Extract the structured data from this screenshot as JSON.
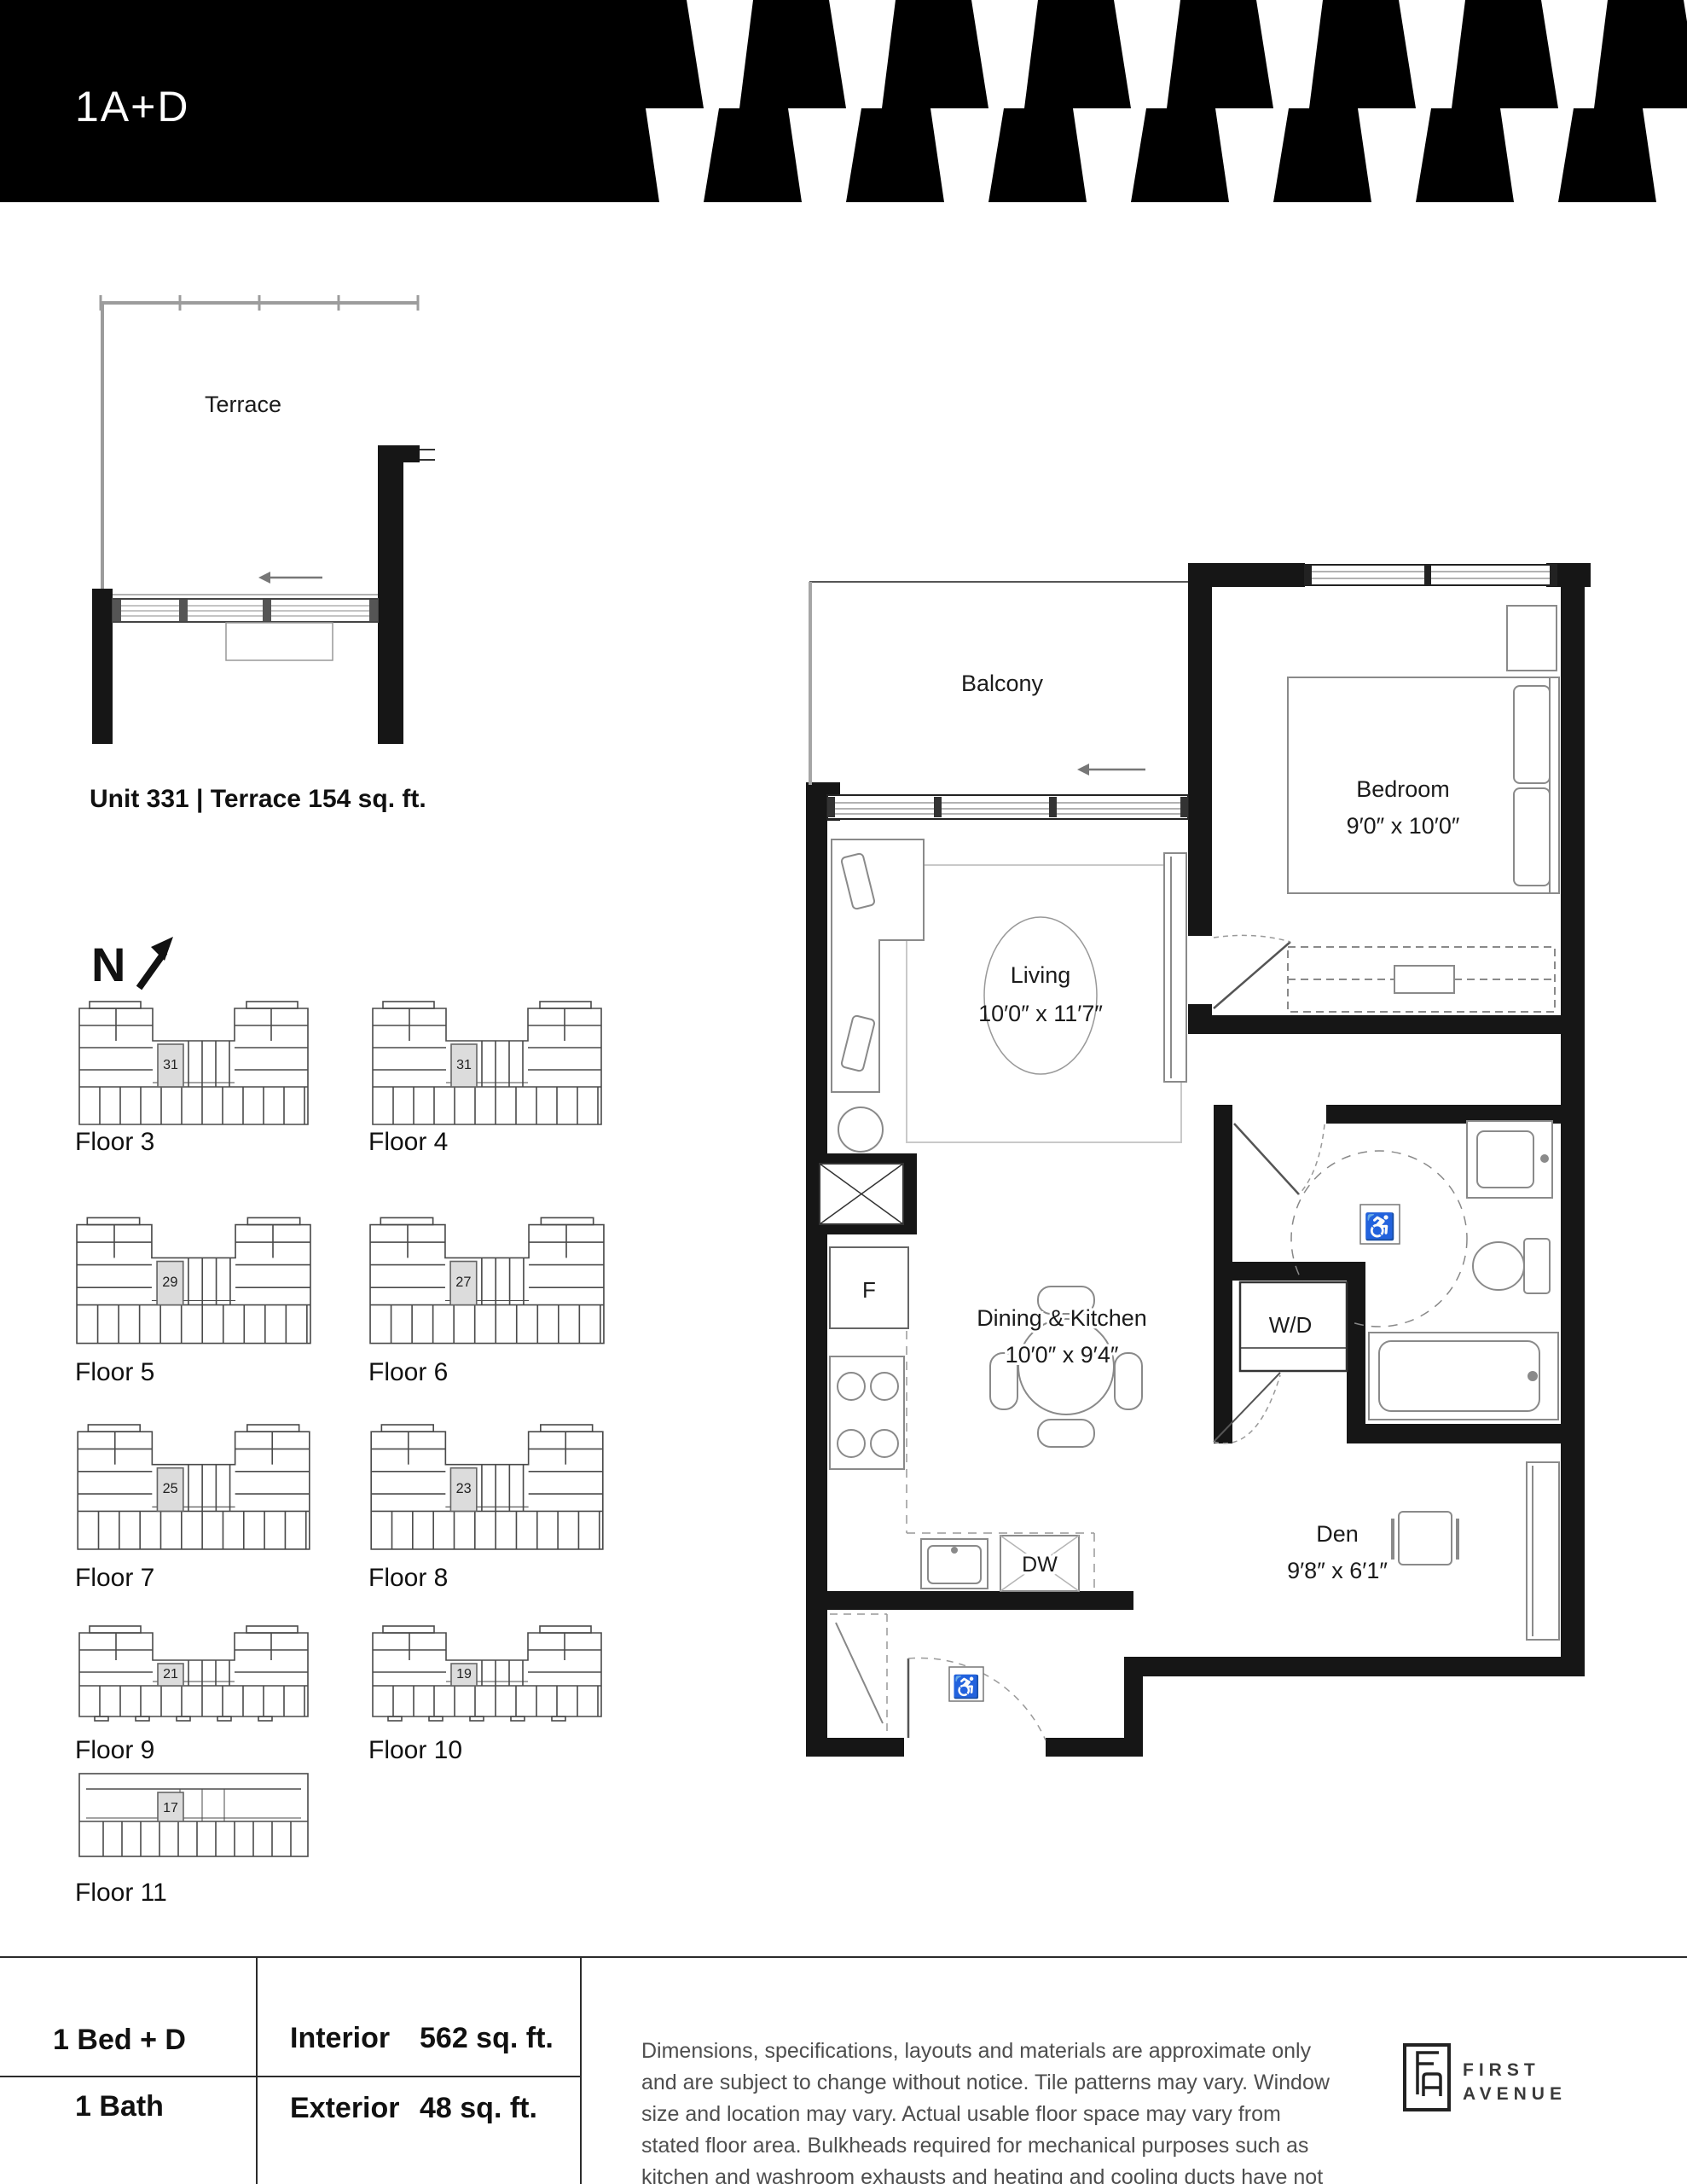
{
  "header": {
    "plan_code": "1A+D"
  },
  "terrace_plan": {
    "label": "Terrace",
    "caption": "Unit 331 | Terrace 154 sq. ft."
  },
  "north": {
    "letter": "N"
  },
  "key_plans": {
    "floors": [
      {
        "label": "Floor 3",
        "unit": "31",
        "shape": "u"
      },
      {
        "label": "Floor 4",
        "unit": "31",
        "shape": "u"
      },
      {
        "label": "Floor 5",
        "unit": "29",
        "shape": "u"
      },
      {
        "label": "Floor 6",
        "unit": "27",
        "shape": "u"
      },
      {
        "label": "Floor 7",
        "unit": "25",
        "shape": "u"
      },
      {
        "label": "Floor 8",
        "unit": "23",
        "shape": "u"
      },
      {
        "label": "Floor 9",
        "unit": "21",
        "shape": "u-low"
      },
      {
        "label": "Floor 10",
        "unit": "19",
        "shape": "u-low"
      },
      {
        "label": "Floor 11",
        "unit": "17",
        "shape": "bar"
      }
    ]
  },
  "floor_plan": {
    "balcony": {
      "label": "Balcony"
    },
    "bedroom": {
      "label": "Bedroom",
      "dims": "9′0″ x 10′0″"
    },
    "living": {
      "label": "Living",
      "dims": "10′0″ x 11′7″"
    },
    "dining": {
      "label": "Dining & Kitchen",
      "dims": "10′0″ x 9′4″"
    },
    "den": {
      "label": "Den",
      "dims": "9′8″ x 6′1″"
    },
    "fridge": "F",
    "washer_dryer": "W/D",
    "dishwasher": "DW",
    "accessible_symbol": "♿"
  },
  "summary": {
    "bed": "1 Bed + D",
    "bath": "1 Bath",
    "interior_label": "Interior",
    "interior_value": "562 sq. ft.",
    "exterior_label": "Exterior",
    "exterior_value": "48 sq. ft."
  },
  "disclaimer": "Dimensions, specifications, layouts and materials are approximate only and are subject to change without notice. Tile patterns may vary. Window size and location may vary. Actual usable floor space may vary from stated floor area. Bulkheads required for mechanical purposes such as kitchen and washroom exhausts and heating and cooling ducts have not been indicated.",
  "brand": {
    "line1": "FIRST",
    "line2": "AVENUE"
  }
}
